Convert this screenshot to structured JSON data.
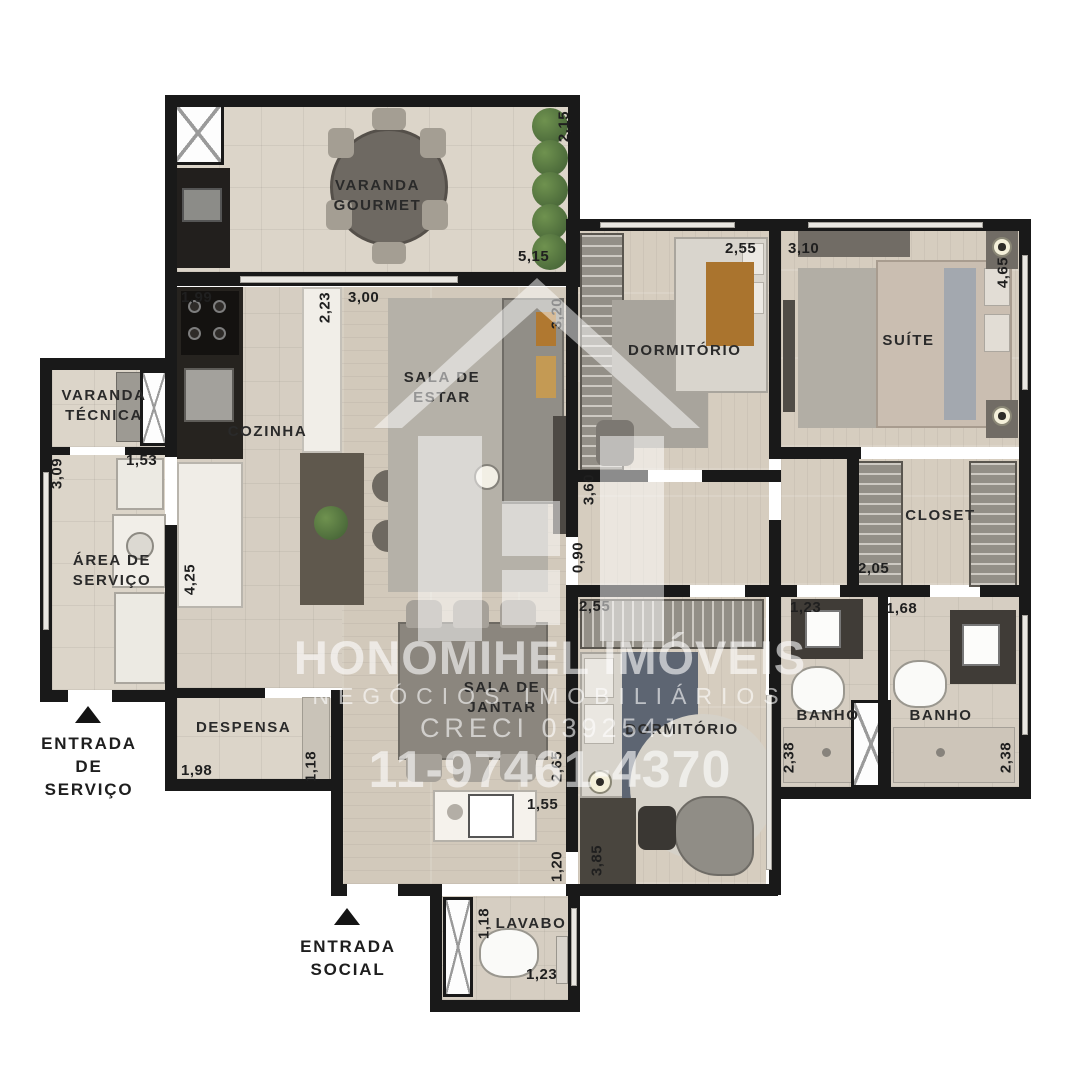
{
  "watermark": {
    "brand": "HONOMIHEL IMÓVEIS",
    "tagline": "NEGÓCIOS IMOBILIÁRIOS",
    "creci": "CRECI 039254J",
    "phone": "11-97461-4370"
  },
  "rooms": {
    "varanda_gourmet": "VARANDA GOURMET",
    "cozinha": "COZINHA",
    "sala_estar": "SALA DE ESTAR",
    "dormitorio_1": "DORMITÓRIO",
    "suite": "SUÍTE",
    "closet": "CLOSET",
    "varanda_tecnica": "VARANDA TÉCNICA",
    "area_servico": "ÁREA DE SERVIÇO",
    "despensa": "DESPENSA",
    "sala_jantar": "SALA DE JANTAR",
    "dormitorio_2": "DORMITÓRIO",
    "banho_1": "BANHO",
    "banho_2": "BANHO",
    "lavabo": "LAVABO"
  },
  "entrances": {
    "servico": "ENTRADA DE SERVIÇO",
    "social": "ENTRADA SOCIAL"
  },
  "dims": {
    "d215": "2,15",
    "d515": "5,15",
    "d199": "1,99",
    "d223": "2,23",
    "d300": "3,00",
    "d320": "3,20",
    "d255a": "2,55",
    "d310": "3,10",
    "d465": "4,65",
    "d309": "3,09",
    "d153": "1,53",
    "d425": "4,25",
    "d360": "3,60",
    "d090": "0,90",
    "d205": "2,05",
    "d123a": "1,23",
    "d168": "1,68",
    "d238a": "2,38",
    "d238b": "2,38",
    "d255b": "2,55",
    "d198": "1,98",
    "d118a": "1,18",
    "d265": "2,65",
    "d155": "1,55",
    "d120": "1,20",
    "d385": "3,85",
    "d118b": "1,18",
    "d123b": "1,23"
  },
  "colors": {
    "wall": "#191919",
    "floor_tile": "#dcd5c9",
    "floor_wood": "#d2c9bb",
    "plant_green": "#4f6f41",
    "label_text": "#2a2a2a",
    "watermark": "#ffffff"
  }
}
